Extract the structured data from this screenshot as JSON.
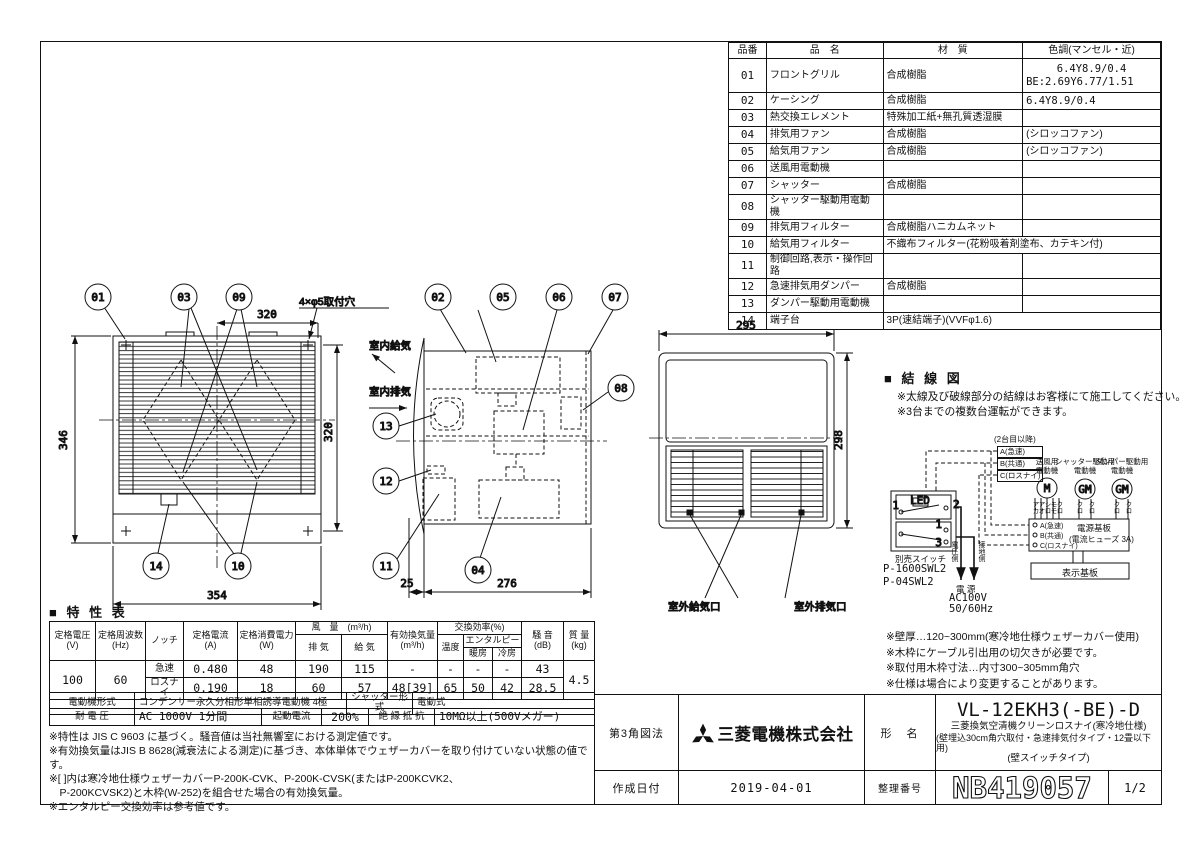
{
  "parts_table": {
    "headers": [
      "品番",
      "品　名",
      "材　質",
      "色調(マンセル・近)"
    ],
    "rows": [
      {
        "no": "01",
        "name": "フロントグリル",
        "material": "合成樹脂",
        "color": "6.4Y8.9/0.4",
        "color2": "BE:2.69Y6.77/1.51"
      },
      {
        "no": "02",
        "name": "ケーシング",
        "material": "合成樹脂",
        "color": "6.4Y8.9/0.4"
      },
      {
        "no": "03",
        "name": "熱交換エレメント",
        "material": "特殊加工紙+無孔質透湿膜",
        "color": ""
      },
      {
        "no": "04",
        "name": "排気用ファン",
        "material": "合成樹脂",
        "color": "(シロッコファン)"
      },
      {
        "no": "05",
        "name": "給気用ファン",
        "material": "合成樹脂",
        "color": "(シロッコファン)"
      },
      {
        "no": "06",
        "name": "送風用電動機",
        "material": "",
        "color": ""
      },
      {
        "no": "07",
        "name": "シャッター",
        "material": "合成樹脂",
        "color": ""
      },
      {
        "no": "08",
        "name": "シャッター駆動用電動機",
        "material": "",
        "color": ""
      },
      {
        "no": "09",
        "name": "排気用フィルター",
        "material": "合成樹脂ハニカムネット",
        "color": ""
      },
      {
        "no": "10",
        "name": "給気用フィルター",
        "material": "不織布フィルター(花粉吸着剤塗布、カテキン付)",
        "color": ""
      },
      {
        "no": "11",
        "name": "制御回路,表示・操作回路",
        "material": "",
        "color": ""
      },
      {
        "no": "12",
        "name": "急速排気用ダンパー",
        "material": "合成樹脂",
        "color": ""
      },
      {
        "no": "13",
        "name": "ダンパー駆動用電動機",
        "material": "",
        "color": ""
      },
      {
        "no": "14",
        "name": "端子台",
        "material": "3P(速結端子)(VVFφ1.6)",
        "color": ""
      }
    ]
  },
  "views": {
    "callouts": {
      "c01": "01",
      "c02": "02",
      "c03": "03",
      "c04": "04",
      "c05": "05",
      "c06": "06",
      "c07": "07",
      "c08": "08",
      "c09": "09",
      "c10": "10",
      "c11": "11",
      "c12": "12",
      "c13": "13",
      "c14": "14"
    },
    "dims": {
      "front_top": "320",
      "front_left": "346",
      "front_bottom": "354",
      "front_right": "320",
      "side_front": "25",
      "side_depth": "276",
      "rear_width": "295",
      "rear_height": "298"
    },
    "labels": {
      "mount_holes": "4×φ5取付穴",
      "indoor_supply": "室内給気",
      "indoor_exhaust": "室内排気",
      "outdoor_supply": "室外給気口",
      "outdoor_exhaust": "室外排気口"
    }
  },
  "wiring": {
    "title": "■ 結 線 図",
    "notes": [
      "※太線及び破線部分の結線はお客様にて施工してください。",
      "※3台までの複数台運転ができます。"
    ],
    "second_unit": "(2台目以降)",
    "branch": [
      "A(急速)",
      "B(共通)",
      "C(ロスナイ)"
    ],
    "motor1a": "送風用",
    "motor1b": "電動機",
    "motor2a": "シャッター駆動用",
    "motor2b": "電動機",
    "motor3a": "ダンパー駆動用",
    "motor3b": "電動機",
    "symbols": [
      "M",
      "GM",
      "GM"
    ],
    "colors": [
      "アカ",
      "アオ",
      "シロ",
      "モモ",
      "クロ",
      "クロ",
      "クロ",
      "クロ",
      "クロ"
    ],
    "board_terms": [
      "A(急速)",
      "B(共通)",
      "C(ロスナイ)"
    ],
    "board1": "電源基板",
    "board2": "(電流ヒューズ 3A)",
    "display_board": "表示基板",
    "switch_label": "別売スイッチ",
    "switch_models": [
      "P-1600SWL2",
      "P-04SWL2"
    ],
    "contacts": [
      "1",
      "2",
      "1",
      "3"
    ],
    "led": "LED",
    "voltage_side": "電圧側",
    "ground_side": "接地側",
    "power": "電 源",
    "power_v": "AC100V",
    "power_f": "50/60Hz"
  },
  "install_notes": [
    "※壁厚…120~300mm(寒冷地仕様ウェザーカバー使用)",
    "※木枠にケーブル引出用の切欠きが必要です。",
    "※取付用木枠寸法…内寸300~305mm角穴",
    "※仕様は場合により変更することがあります。"
  ],
  "spec": {
    "title": "■ 特 性 表",
    "h": {
      "voltage1": "定格電圧",
      "voltage2": "(V)",
      "freq1": "定格周波数",
      "freq2": "(Hz)",
      "notch": "ノッチ",
      "current1": "定格電流",
      "current2": "(A)",
      "power1": "定格消費電力",
      "power2": "(W)",
      "airflow": "風　量　(m³/h)",
      "exhaust": "排 気",
      "supply": "給 気",
      "effective1": "有効換気量",
      "effective2": "(m³/h)",
      "exchange": "交換効率(%)",
      "temp": "温度",
      "enthalpy": "エンタルピー",
      "heating": "暖房",
      "cooling": "冷房",
      "noise1": "騒 音",
      "noise2": "(dB)",
      "mass1": "質 量",
      "mass2": "(kg)"
    },
    "voltage": "100",
    "freq": "60",
    "mass": "4.5",
    "rapid": {
      "notch": "急速",
      "current": "0.480",
      "power": "48",
      "exhaust": "190",
      "supply": "115",
      "effective": "-",
      "temp": "-",
      "heating": "-",
      "cooling": "-",
      "noise": "43"
    },
    "lossnay": {
      "notch": "ロスナイ",
      "current": "0.190",
      "power": "18",
      "exhaust": "60",
      "supply": "57",
      "effective": "48[39]",
      "temp": "65",
      "heating": "50",
      "cooling": "42",
      "noise": "28.5"
    },
    "motor": {
      "type_label": "電動機形式",
      "type": "コンデンサー永久分相形単相誘導電動機 4極",
      "shutter_label": "シャッター形式",
      "shutter": "電動式",
      "withstand_label": "耐 電 圧",
      "withstand": "AC 1000V 1分間",
      "inrush_label": "起動電流",
      "inrush": "200%",
      "insulation_label": "絶 縁 抵 抗",
      "insulation": "10MΩ以上(500Vメガー)"
    },
    "notes": [
      "※特性は JIS C 9603 に基づく。騒音値は当社無響室における測定値です。",
      "※有効換気量はJIS B 8628(減衰法による測定)に基づき、本体単体でウェザーカバーを取り付けていない状態の値です。",
      "※[ ]内は寒冷地仕様ウェザーカバーP-200K-CVK、P-200K-CVSK(またはP-200KCVK2、",
      "　P-200KCVSK2)と木枠(W-252)を組合せた場合の有効換気量。",
      "※エンタルピー交換効率は参考値です。"
    ]
  },
  "title_block": {
    "projection": "第3角図法",
    "company": "三菱電機株式会社",
    "model_label": "形　名",
    "model": "VL-12EKH3(-BE)-D",
    "desc1": "三菱換気空清機クリーンロスナイ(寒冷地仕様)",
    "desc2": "(壁埋込30cm角穴取付・急速排気付タイプ・12畳以下用)",
    "desc3": "(壁スイッチタイプ)",
    "date_label": "作成日付",
    "date": "2019-04-01",
    "number_label": "整理番号",
    "number": "NB419057",
    "page": "1/2"
  }
}
